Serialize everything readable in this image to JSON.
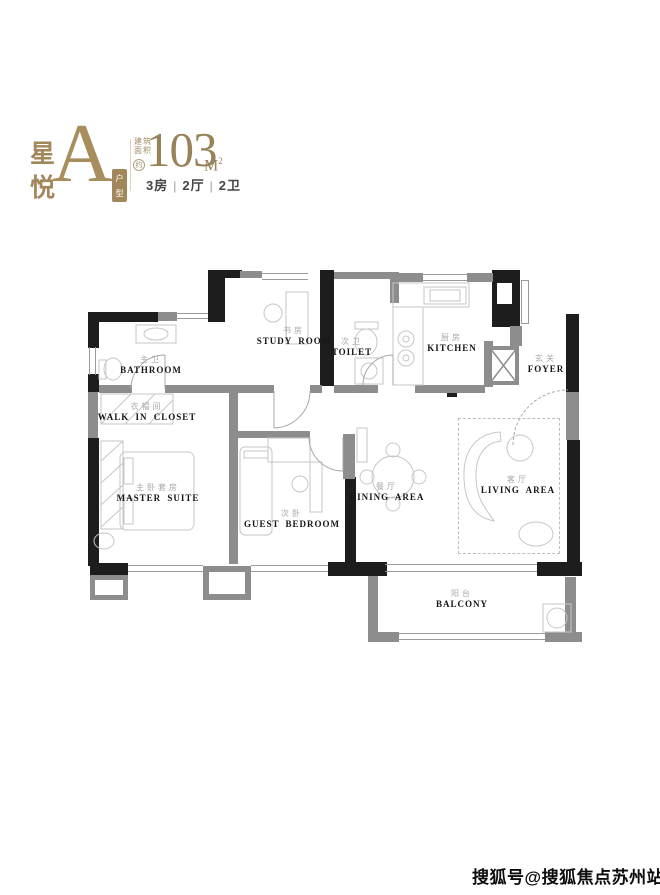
{
  "header": {
    "brand_top": "星",
    "brand_bottom": "悦",
    "unit_letter": "A",
    "unit_tag_top": "户",
    "unit_tag_bottom": "型",
    "area_label_line1": "建筑",
    "area_label_line2": "面积",
    "area_approx": "约",
    "area_value": "103",
    "area_unit_letter": "M",
    "area_unit_sup": "2",
    "spec_parts": [
      "3房",
      "2厅",
      "2卫"
    ],
    "spec_separator": "|"
  },
  "floorplan": {
    "rooms": [
      {
        "cn": "主卫",
        "en": "BATHROOM"
      },
      {
        "cn": "书房",
        "en": "STUDY ROOM"
      },
      {
        "cn": "次卫",
        "en": "TOILET"
      },
      {
        "cn": "厨房",
        "en": "KITCHEN"
      },
      {
        "cn": "玄关",
        "en": "FOYER"
      },
      {
        "cn": "衣帽间",
        "en": "WALK IN CLOSET"
      },
      {
        "cn": "主卧套房",
        "en": "MASTER SUITE"
      },
      {
        "cn": "次卧",
        "en": "GUEST BEDROOM"
      },
      {
        "cn": "餐厅",
        "en": "DINING AREA"
      },
      {
        "cn": "客厅",
        "en": "LIVING AREA"
      },
      {
        "cn": "阳台",
        "en": "BALCONY"
      }
    ]
  },
  "watermark": "搜狐号@搜狐焦点苏州站",
  "colors": {
    "brand_gold": "#a1875a",
    "wall_black": "#1d1d1d",
    "wall_gray": "#8d8d8d",
    "spec_text": "#454545"
  }
}
